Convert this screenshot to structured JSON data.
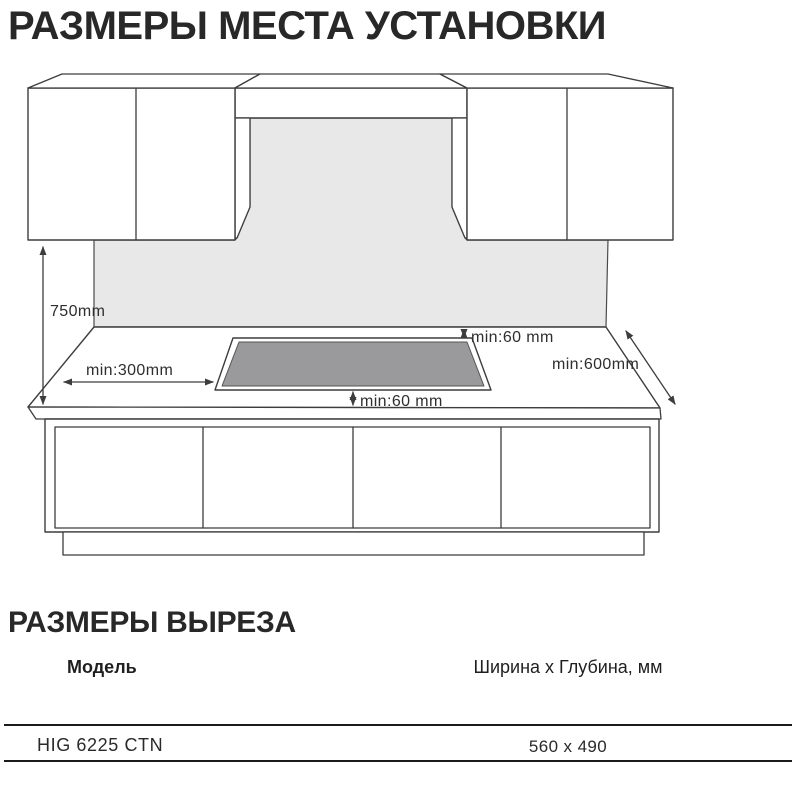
{
  "colors": {
    "wall": "#e8e8e8",
    "hob": "#9a9a9c",
    "line": "#3d3d3d",
    "text": "#2e2e2e",
    "rule": "#1b1b1b",
    "heading": "#282828"
  },
  "section_installation": {
    "title": "РАЗМЕРЫ МЕСТА УСТАНОВКИ"
  },
  "diagram": {
    "labels": {
      "height": "750mm",
      "left_clearance": "min:300mm",
      "back_clearance": "min:60 mm",
      "front_clearance": "min:60 mm",
      "depth": "min:600mm"
    }
  },
  "section_cutout": {
    "title": "РАЗМЕРЫ ВЫРЕЗА",
    "table": {
      "columns": [
        {
          "label": "Модель"
        },
        {
          "label": "Ширина x Глубина, мм"
        }
      ],
      "rows": [
        {
          "model": "HIG 6225 CTN",
          "size": "560 x 490"
        }
      ]
    }
  }
}
